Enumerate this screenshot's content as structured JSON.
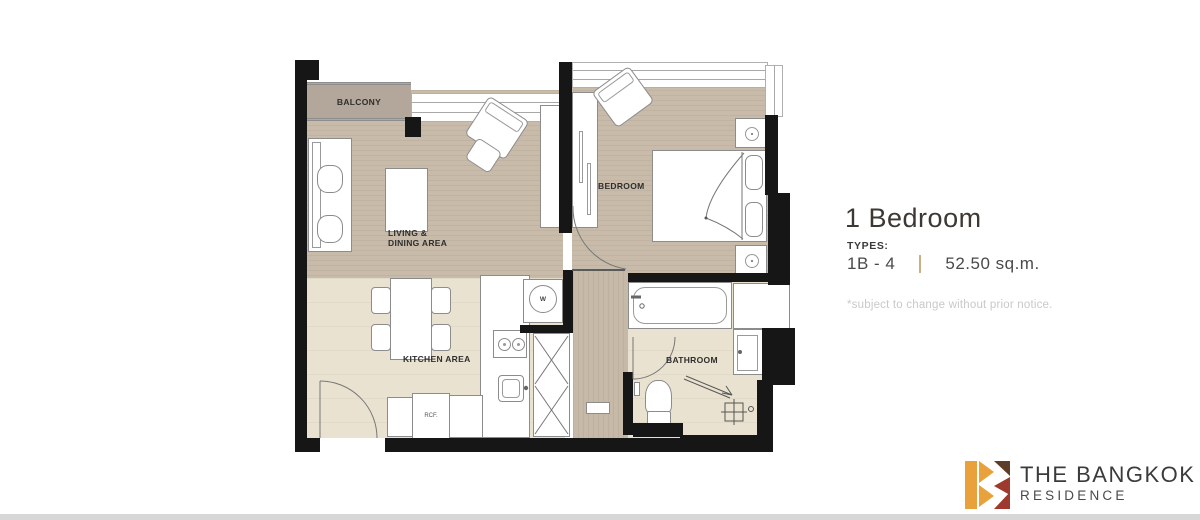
{
  "page": {
    "background": "#ffffff",
    "footer_bar_color": "#d7d7d7"
  },
  "floor_plan": {
    "labels": {
      "balcony": "BALCONY",
      "living_line1": "LIVING &",
      "living_line2": "DINING AREA",
      "bedroom": "BEDROOM",
      "kitchen": "KITCHEN AREA",
      "bathroom": "BATHROOM"
    },
    "appliance_labels": {
      "washer": "W",
      "refrigerator": "RCF."
    },
    "colors": {
      "wall": "#161616",
      "wood_floor": "#c8bbaa",
      "tile_floor": "#e9e2d0",
      "balcony_floor": "#b3a79c",
      "furniture_fill": "#ffffff",
      "furniture_outline": "#8c8c8c"
    }
  },
  "unit_info": {
    "title": "1 Bedroom",
    "types_label": "TYPES:",
    "type_code": "1B - 4",
    "area": "52.50 sq.m.",
    "disclaimer": "*subject to change without prior notice.",
    "divider_color": "#c6b27e"
  },
  "brand": {
    "name": "THE BANGKOK",
    "sub_name": "RESIDENCE",
    "logo_colors": {
      "orange": "#e9a23b",
      "brown": "#5d3d28",
      "red": "#9e3a2d"
    }
  }
}
